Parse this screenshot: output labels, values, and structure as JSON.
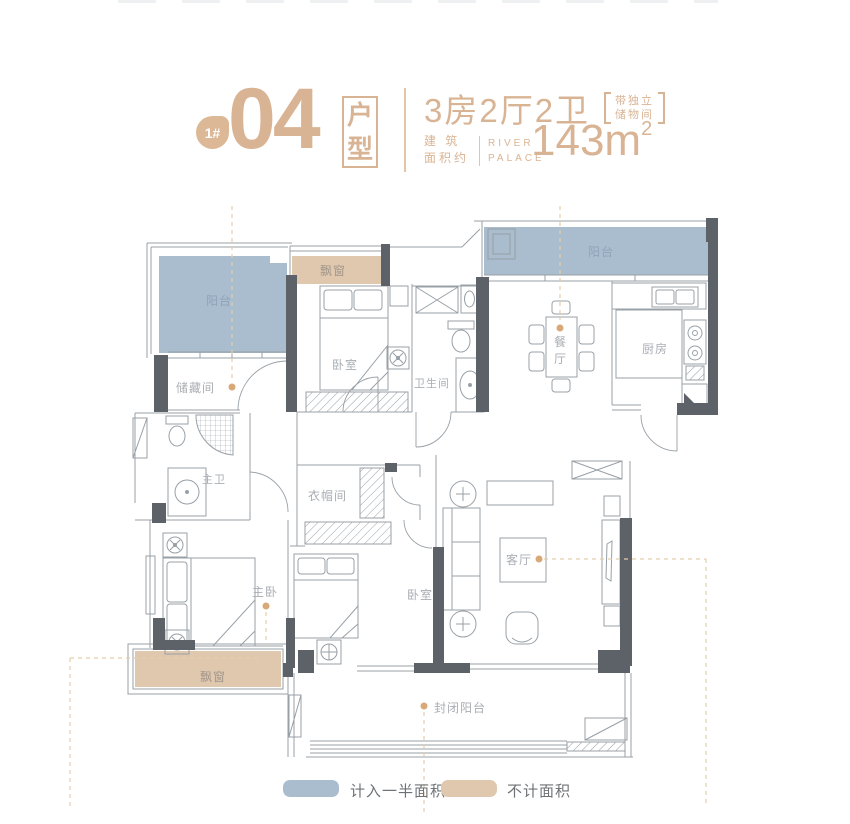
{
  "header": {
    "building_no": "1#",
    "unit_no": "04",
    "unit_type_label": "户型",
    "layout_text": "3房2厅2卫",
    "note_line1": "带独立",
    "note_line2": "储物间",
    "area_prefix_line1": "建 筑",
    "area_prefix_line2": "面积约",
    "brand_line1": "RIVER",
    "brand_line2": "PALACE",
    "area_value": "143m",
    "area_superscript": "2"
  },
  "floorplan": {
    "rooms": {
      "balcony_left": "阳台",
      "bay_window_top": "飘窗",
      "bedroom_top": "卧室",
      "storage": "储藏间",
      "balcony_right": "阳台",
      "dining": "餐厅",
      "kitchen": "厨房",
      "bathroom": "卫生间",
      "master_bath": "主卫",
      "cloakroom": "衣帽间",
      "master_bedroom": "主卧",
      "bedroom_bottom": "卧室",
      "living": "客厅",
      "enclosed_balcony": "封闭阳台",
      "bay_window_bottom": "飘窗"
    }
  },
  "legend": {
    "items": [
      {
        "label": "计入一半面积",
        "color": "#a9bdce"
      },
      {
        "label": "不计面积",
        "color": "#e0c8af"
      }
    ]
  },
  "colors": {
    "accent": "#d9b494",
    "half_area_fill": "#a9bdce",
    "excluded_fill": "#e0c8af",
    "wall": "#5c6267",
    "line": "#98a0a7",
    "dash": "#e4cdab",
    "dot": "#d9a877",
    "room_label": "#a9aeb4"
  }
}
